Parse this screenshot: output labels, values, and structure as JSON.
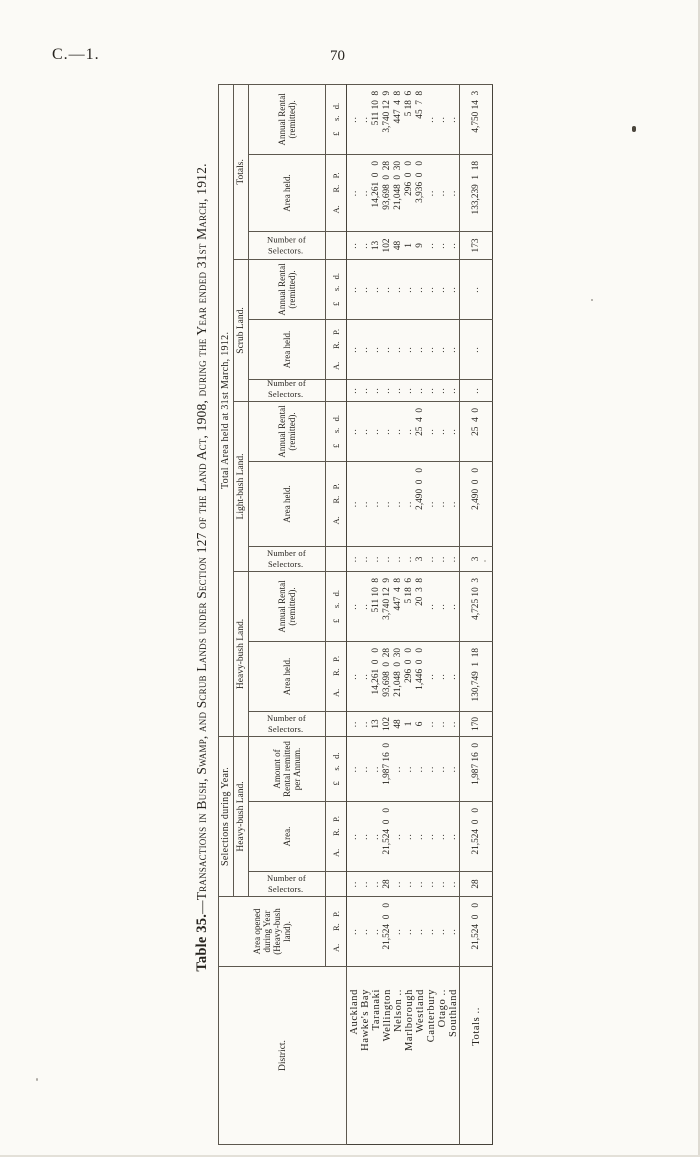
{
  "page": {
    "doc_ref": "C.—1.",
    "page_number": "70"
  },
  "table": {
    "title_lead": "Table 35.",
    "title_rest": "—Transactions in Bush, Swamp, and Scrub Lands under Section 127 of the Land Act, 1908, during the Year ended 31st March, 1912.",
    "headers": {
      "district": "District.",
      "area_opened": "Area opened during Year (Heavy-bush land).",
      "selections": "Selections during Year.",
      "total_area": "Total Area held at 31st March, 1912.",
      "heavy_bush": "Heavy-bush Land.",
      "light_bush": "Light-bush Land.",
      "scrub": "Scrub Land.",
      "totals_group": "Totals.",
      "num_selectors": "Number of Selectors.",
      "area": "Area.",
      "area_held": "Area held.",
      "rental_per_annum": "Amount of Rental remitted per Annum.",
      "annual_rental": "Annual Rental (remitted).",
      "unit_arp": "A.      R.   P.",
      "unit_lsd": "£     s.   d."
    },
    "rows": [
      {
        "district": "Auckland",
        "cells": [
          "..",
          "..",
          "..",
          "..",
          "..",
          "..",
          "..",
          "..",
          "..",
          "..",
          "..",
          "..",
          "..",
          "..",
          "..",
          ".."
        ]
      },
      {
        "district": "Hawke's Bay",
        "cells": [
          "..",
          "..",
          "..",
          "..",
          "..",
          "..",
          "..",
          "..",
          "..",
          "..",
          "..",
          "..",
          "..",
          "..",
          "..",
          ".."
        ]
      },
      {
        "district": "Taranaki",
        "cells": [
          "..",
          "..",
          "..",
          "..",
          "13",
          "14,261  0   0",
          "511 10  8",
          "..",
          "..",
          "..",
          "..",
          "..",
          "..",
          "13",
          "14,261  0   0",
          "511 10  8"
        ]
      },
      {
        "district": "Wellington",
        "cells": [
          "21,524  0   0",
          "28",
          "21,524  0   0",
          "1,987 16  0",
          "102",
          "93,698  0  28",
          "3,740 12  9",
          "..",
          "..",
          "..",
          "..",
          "..",
          "..",
          "102",
          "93,698  0  28",
          "3,740 12  9"
        ]
      },
      {
        "district": "Nelson ..",
        "cells": [
          "..",
          "..",
          "..",
          "..",
          "48",
          "21,048  0  30",
          "447  4  8",
          "..",
          "..",
          "..",
          "..",
          "..",
          "..",
          "48",
          "21,048  0  30",
          "447  4  8"
        ]
      },
      {
        "district": "Marlborough",
        "cells": [
          "..",
          "..",
          "..",
          "..",
          "1",
          "296  0   0",
          "5 18  6",
          "..",
          "..",
          "..",
          "..",
          "..",
          "..",
          "1",
          "296  0   0",
          "5 18  6"
        ]
      },
      {
        "district": "Westland",
        "cells": [
          "..",
          "..",
          "..",
          "..",
          "6",
          "1,446  0   0",
          "20  3  8",
          "3",
          "2,490  0   0",
          "25  4  0",
          "..",
          "..",
          "..",
          "9",
          "3,936  0   0",
          "45  7  8"
        ]
      },
      {
        "district": "Canterbury",
        "cells": [
          "..",
          "..",
          "..",
          "..",
          "..",
          "..",
          "..",
          "..",
          "..",
          "..",
          "..",
          "..",
          "..",
          "..",
          "..",
          ".."
        ]
      },
      {
        "district": "Otago ..",
        "cells": [
          "..",
          "..",
          "..",
          "..",
          "..",
          "..",
          "..",
          "..",
          "..",
          "..",
          "..",
          "..",
          "..",
          "..",
          "..",
          ".."
        ]
      },
      {
        "district": "Southland",
        "cells": [
          "..",
          "..",
          "..",
          "..",
          "..",
          "..",
          "..",
          "..",
          "..",
          "..",
          "..",
          "..",
          "..",
          "..",
          "..",
          ".."
        ]
      }
    ],
    "totals_row": {
      "district": "Totals ..",
      "cells": [
        "21,524  0   0",
        "28",
        "21,524  0   0",
        "1,987 16  0",
        "170",
        "130,749  1  18",
        "4,725 10  3",
        "3",
        "2,490  0   0",
        "25  4  0",
        "..",
        "..",
        "..",
        "173",
        "133,239  1  18",
        "4,750 14  3"
      ]
    }
  }
}
